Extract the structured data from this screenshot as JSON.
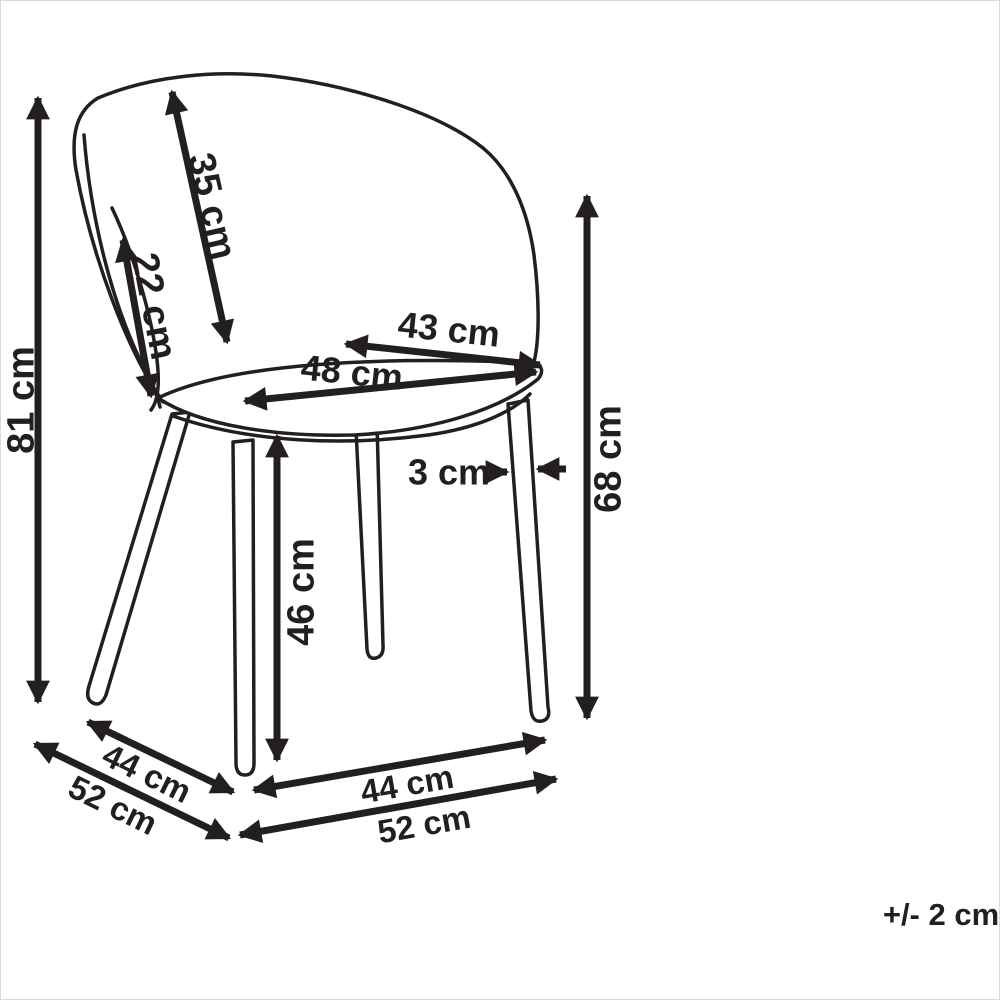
{
  "figure": {
    "subject": "Chair dimension diagram",
    "units": "cm",
    "ink_color": "#231f20",
    "background_color": "#ffffff"
  },
  "labels": {
    "overall_height": "81 cm",
    "backrest_length": "35 cm",
    "backrest_side_length": "22 cm",
    "seat_back_width": "43 cm",
    "seat_width": "48 cm",
    "back_height_from_floor": "68 cm",
    "leg_thickness": "3 cm",
    "seat_height": "46 cm",
    "base_side_depth": "44 cm",
    "base_side_depth_outer": "52 cm",
    "base_front_width": "44 cm",
    "base_front_width_outer": "52 cm",
    "tolerance": "+/- 2 cm"
  }
}
